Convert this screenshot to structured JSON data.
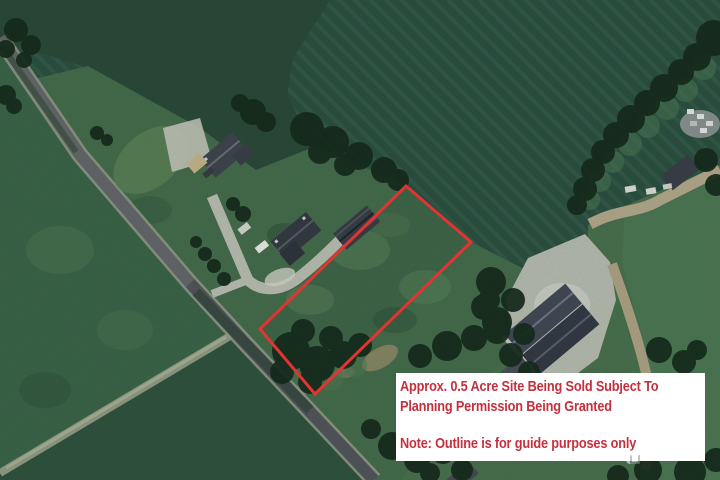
{
  "annotation": {
    "line1": "Approx. 0.5 Acre Site Being Sold Subject To",
    "line2": "Planning Permission Being Granted",
    "note": "Note: Outline is for guide purposes only",
    "text_color": "#c5303e",
    "background_color": "#ffffff"
  },
  "site": {
    "outline_points": "406,186 471,242 315,394 260,329",
    "outline_color": "#e23430",
    "outline_width": "3"
  },
  "watermark": {
    "text": "daft.ie",
    "icon": "daft-logo-icon"
  }
}
